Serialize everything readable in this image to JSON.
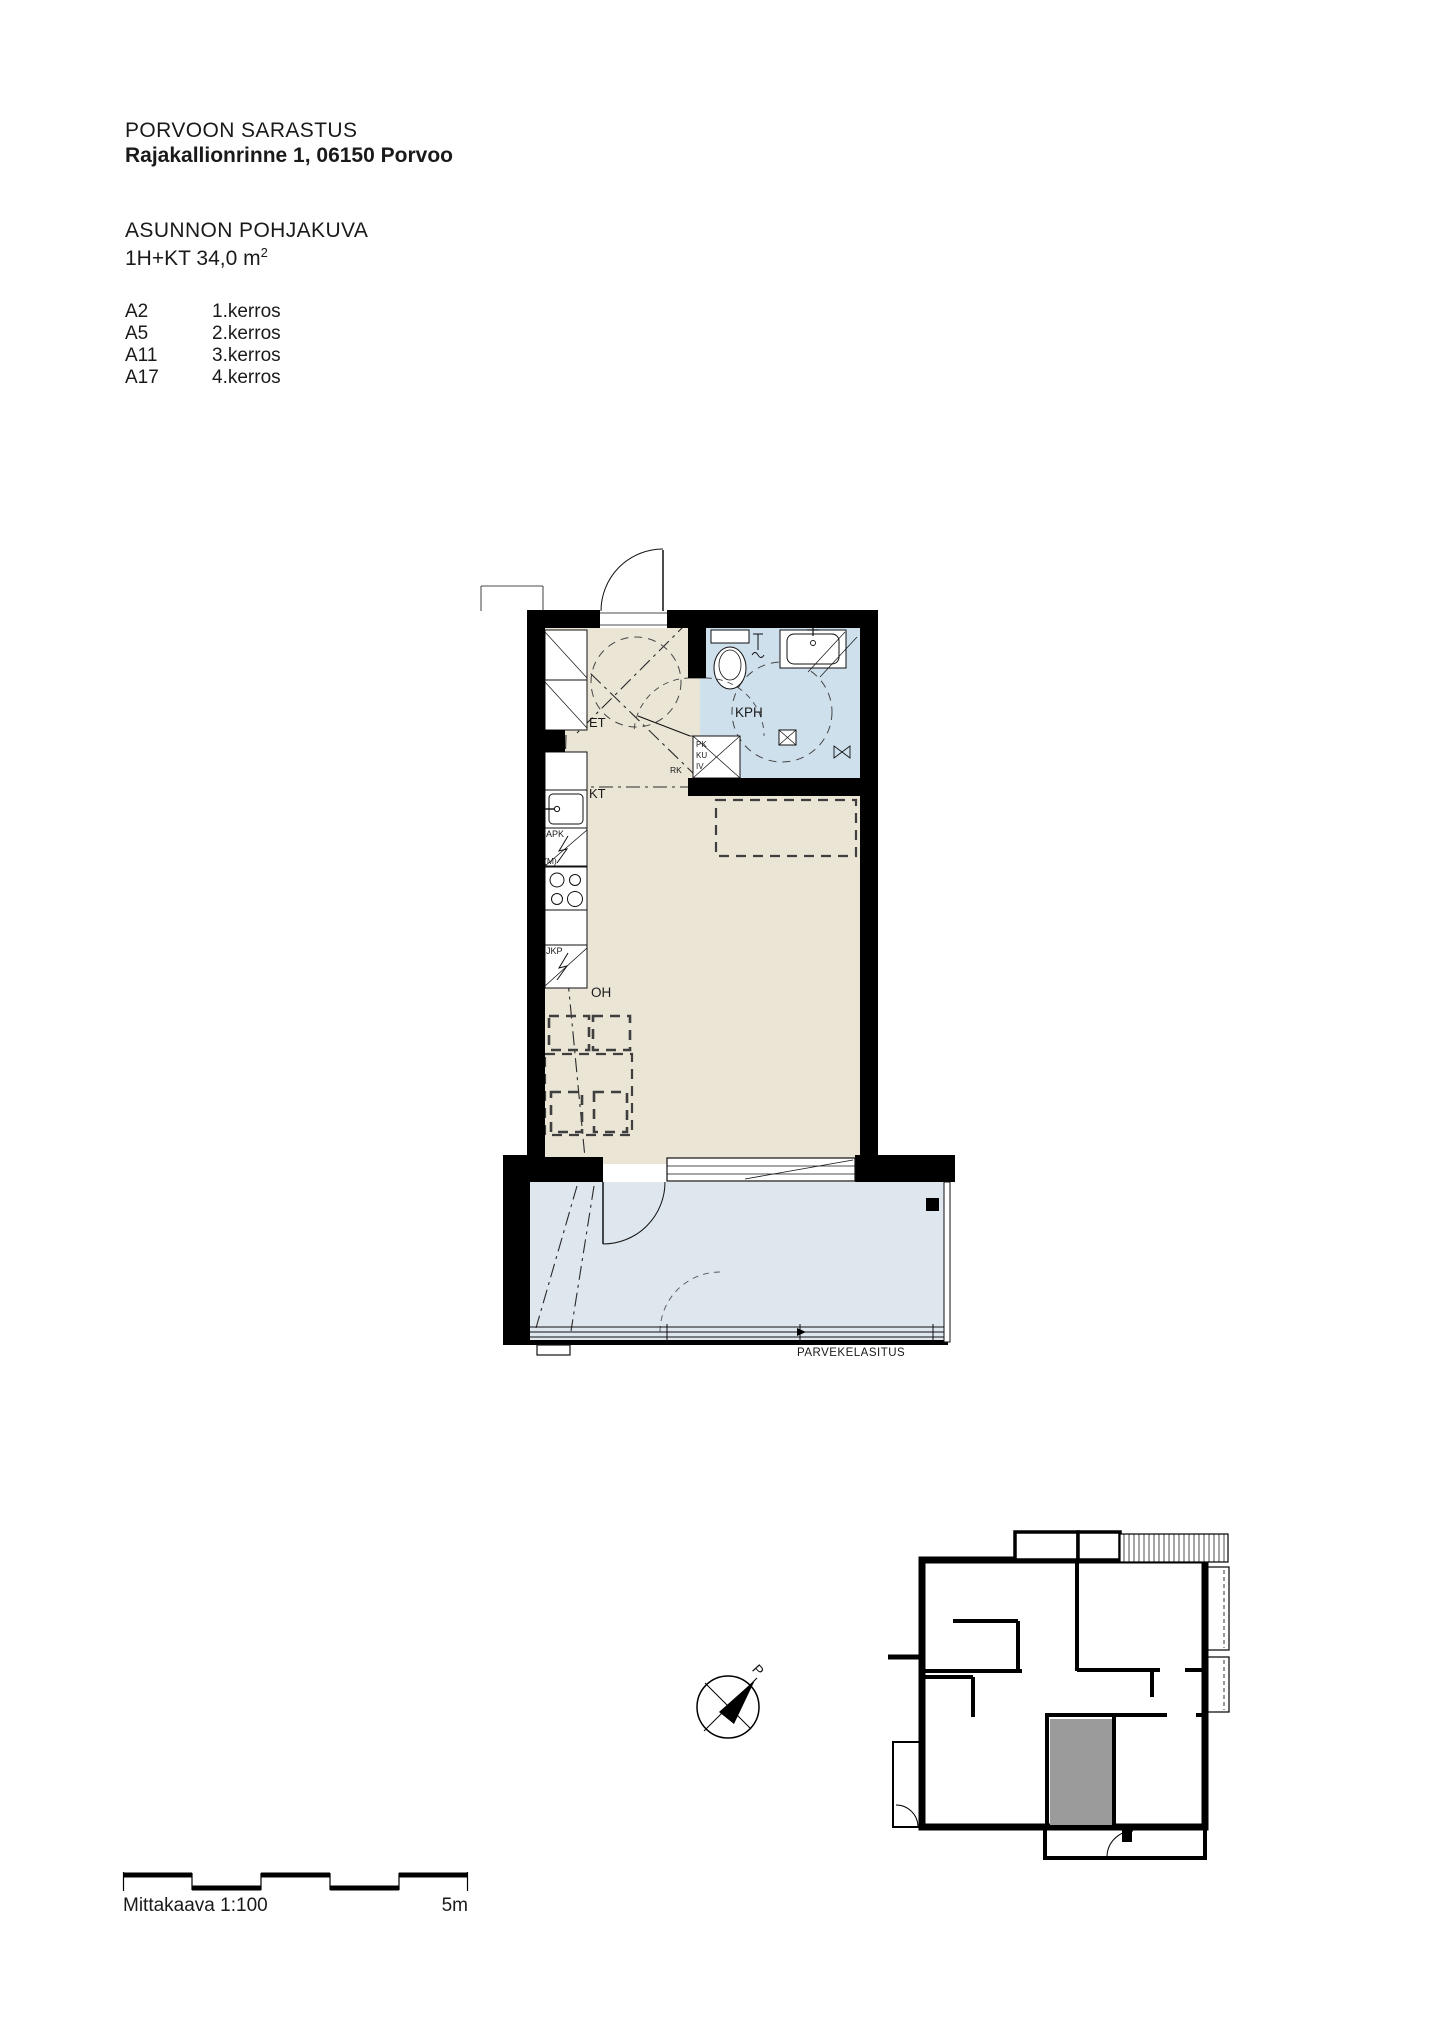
{
  "header": {
    "project": "PORVOON SARASTUS",
    "address": "Rajakallionrinne 1, 06150 Porvoo",
    "drawing_title": "ASUNNON POHJAKUVA",
    "apartment_type": "1H+KT 34,0 m",
    "area_exponent": "2"
  },
  "apartment_list": [
    {
      "unit": "A2",
      "floor": "1.kerros"
    },
    {
      "unit": "A5",
      "floor": "2.kerros"
    },
    {
      "unit": "A11",
      "floor": "3.kerros"
    },
    {
      "unit": "A17",
      "floor": "4.kerros"
    }
  ],
  "plan_labels": {
    "entry": "ET",
    "bathroom": "KPH",
    "kitchen": "KT",
    "living": "OH",
    "dishwasher": "APK",
    "microwave": "(M)",
    "fridge": "JKP",
    "electrical": "RK",
    "washer_line1": "PK",
    "washer_line2": "KU",
    "washer_line3": "IV",
    "balcony_glazing": "PARVEKELASITUS"
  },
  "compass": {
    "north": "P"
  },
  "scale": {
    "label": "Mittakaava 1:100",
    "length": "5m"
  },
  "colors": {
    "floor": "#ebe5d6",
    "bathroom": "#cfe0ed",
    "balcony": "#dfe7ee",
    "wall": "#000000",
    "highlight": "#9b9b9b"
  }
}
